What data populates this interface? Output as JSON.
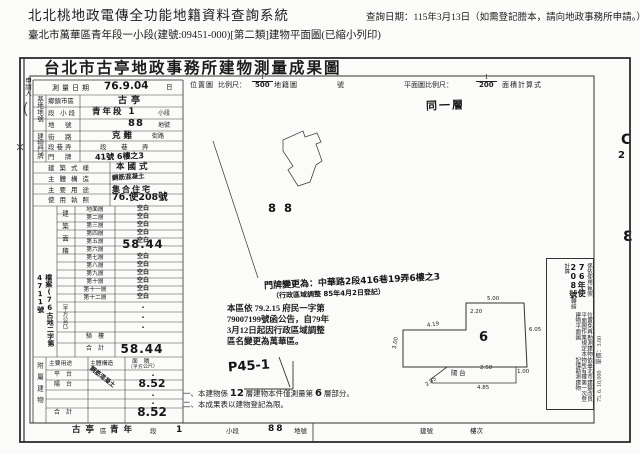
{
  "header": {
    "system_title": "北北桃地政電傳全功能地籍資料查詢系統",
    "subtitle": "臺北市萬華區青年段一小段(建號:09451-000)[第二類]建物平面圖(已縮小列印)",
    "query_date": "查詢日期：115年3月13日（如需登記謄本，請向地政事務所申請。）"
  },
  "doc": {
    "title": "台北市古亭地政事務所建物測量成果圖",
    "applicant_label": "申請人",
    "row_survey": {
      "label": "測量日期",
      "value": "76.9.04",
      "unit": "日"
    },
    "scale_bar": {
      "location_label": "位置圖",
      "ratio_label": "比例尺：",
      "loc_num": "1",
      "loc_den": "500",
      "cad_label": "地籍圖",
      "no_label": "號",
      "plan_label": "平面圖比例尺：",
      "plan_num": "1",
      "plan_den": "200",
      "calc_label": "面積計算式"
    },
    "site_group": "基地地號",
    "site_rows": [
      {
        "label": "鄉鎮市區",
        "value": "古亭",
        "suffix": ""
      },
      {
        "label": "段 小段",
        "value": "青年段 1",
        "suffix": "小段"
      },
      {
        "label": "地　號",
        "value": "88",
        "suffix": "地號"
      }
    ],
    "addr_group": "建物門牌",
    "addr_rows": [
      {
        "label": "街　路",
        "value": "克難",
        "suffix": "街路"
      },
      {
        "label": "段巷弄",
        "value": "段　巷　弄",
        "suffix": ""
      },
      {
        "label": "門　牌",
        "value": "41號 6樓之3",
        "suffix": ""
      }
    ],
    "attr_rows": [
      {
        "label": "建築式樣",
        "value": "本國式"
      },
      {
        "label": "主體構造",
        "value": "鋼筋混凝土"
      },
      {
        "label": "主要用途",
        "value": "集合住宅"
      },
      {
        "label": "使用執照",
        "value": "76.使208號"
      }
    ],
    "floor_group": "建築面積",
    "floor_unit": "（平方公尺）",
    "floor_rows": [
      {
        "floor": "地面層",
        "value": "空白"
      },
      {
        "floor": "第二層",
        "value": "空白"
      },
      {
        "floor": "第三層",
        "value": "空白"
      },
      {
        "floor": "第四層",
        "value": "空白"
      },
      {
        "floor": "第五層",
        "value": "空白"
      },
      {
        "floor": "第六層",
        "value": "58.44"
      },
      {
        "floor": "第七層",
        "value": "空白"
      },
      {
        "floor": "第八層",
        "value": "空白"
      },
      {
        "floor": "第九層",
        "value": "空白"
      },
      {
        "floor": "第十層",
        "value": "空白"
      },
      {
        "floor": "第十一層",
        "value": "空白"
      },
      {
        "floor": "第十二層",
        "value": "空白"
      }
    ],
    "dot": "·",
    "qilou_label": "騎　樓",
    "total_label": "合　計",
    "floor_total": "58.44",
    "annex_group": "附屬建物",
    "annex_headers": {
      "use": "主要用途",
      "structure": "主體構造",
      "area": "面　積",
      "area_unit": "（平方公尺）"
    },
    "annex_rows": [
      {
        "use": "平　台",
        "structure": "",
        "area": ""
      },
      {
        "use": "陽　台",
        "structure": "鋼筋混凝土",
        "area": "8.52"
      }
    ],
    "annex_total": "8.52",
    "margin_file_note": "檔案(76古地二字第4711號",
    "same_floor": "同一層",
    "site_parcel": "8 8",
    "doorplate_note_line1": "門牌變更為：中華路2段416巷19弄6樓之3",
    "doorplate_note_line2": "（行政區域調整 85年4月2日登記）",
    "stamp_lines": [
      "本區依 79.2.15 府民一字第",
      "79007199號函公告，自79年",
      "3月12日起因行政區域調整",
      "區名變更為萬華區。"
    ],
    "page_mark": "P45-1",
    "plan": {
      "room": "6",
      "balcony": "陽 台",
      "dim_top": "5.00",
      "dim_notch": "2.20",
      "dim_upper_left": "4.19",
      "dim_left": "3.00",
      "dim_right": "6.05",
      "dim_b_top": "2.58",
      "dim_b_left": "2.05",
      "dim_b_bottom": "4.85",
      "dim_b_right": "1.00"
    },
    "remarks": {
      "col1": "依臺北市建築改良物所有權第一次登記僅勘測建物",
      "col2": "位置免再勘測建物平面圖作業規定本建物平面圖",
      "col3_pre": "係依使用執照",
      "col3_hand": "76年使208號",
      "col3_post": "轉繪計算"
    },
    "print_note": "75. 6. 10,000　單價：3.60",
    "margin_marks": {
      "m1": "C",
      "m2": "2",
      "m3": "Ɛ"
    },
    "notes": {
      "n1_pre": "一、本建物係",
      "n1_num": "12",
      "n1_mid": "層建物本件僅測量第",
      "n1_num2": "6",
      "n1_post": "層部分。",
      "n2": "二、本成果表以建物登記為限。"
    },
    "strip": {
      "district": "古亭",
      "district_l": "區",
      "section": "青年",
      "section_l": "段",
      "sub": "1",
      "sub_l": "小段",
      "parcel": "88",
      "parcel_l": "地號",
      "bldg_l": "建號",
      "floor_l": "樓次"
    }
  }
}
